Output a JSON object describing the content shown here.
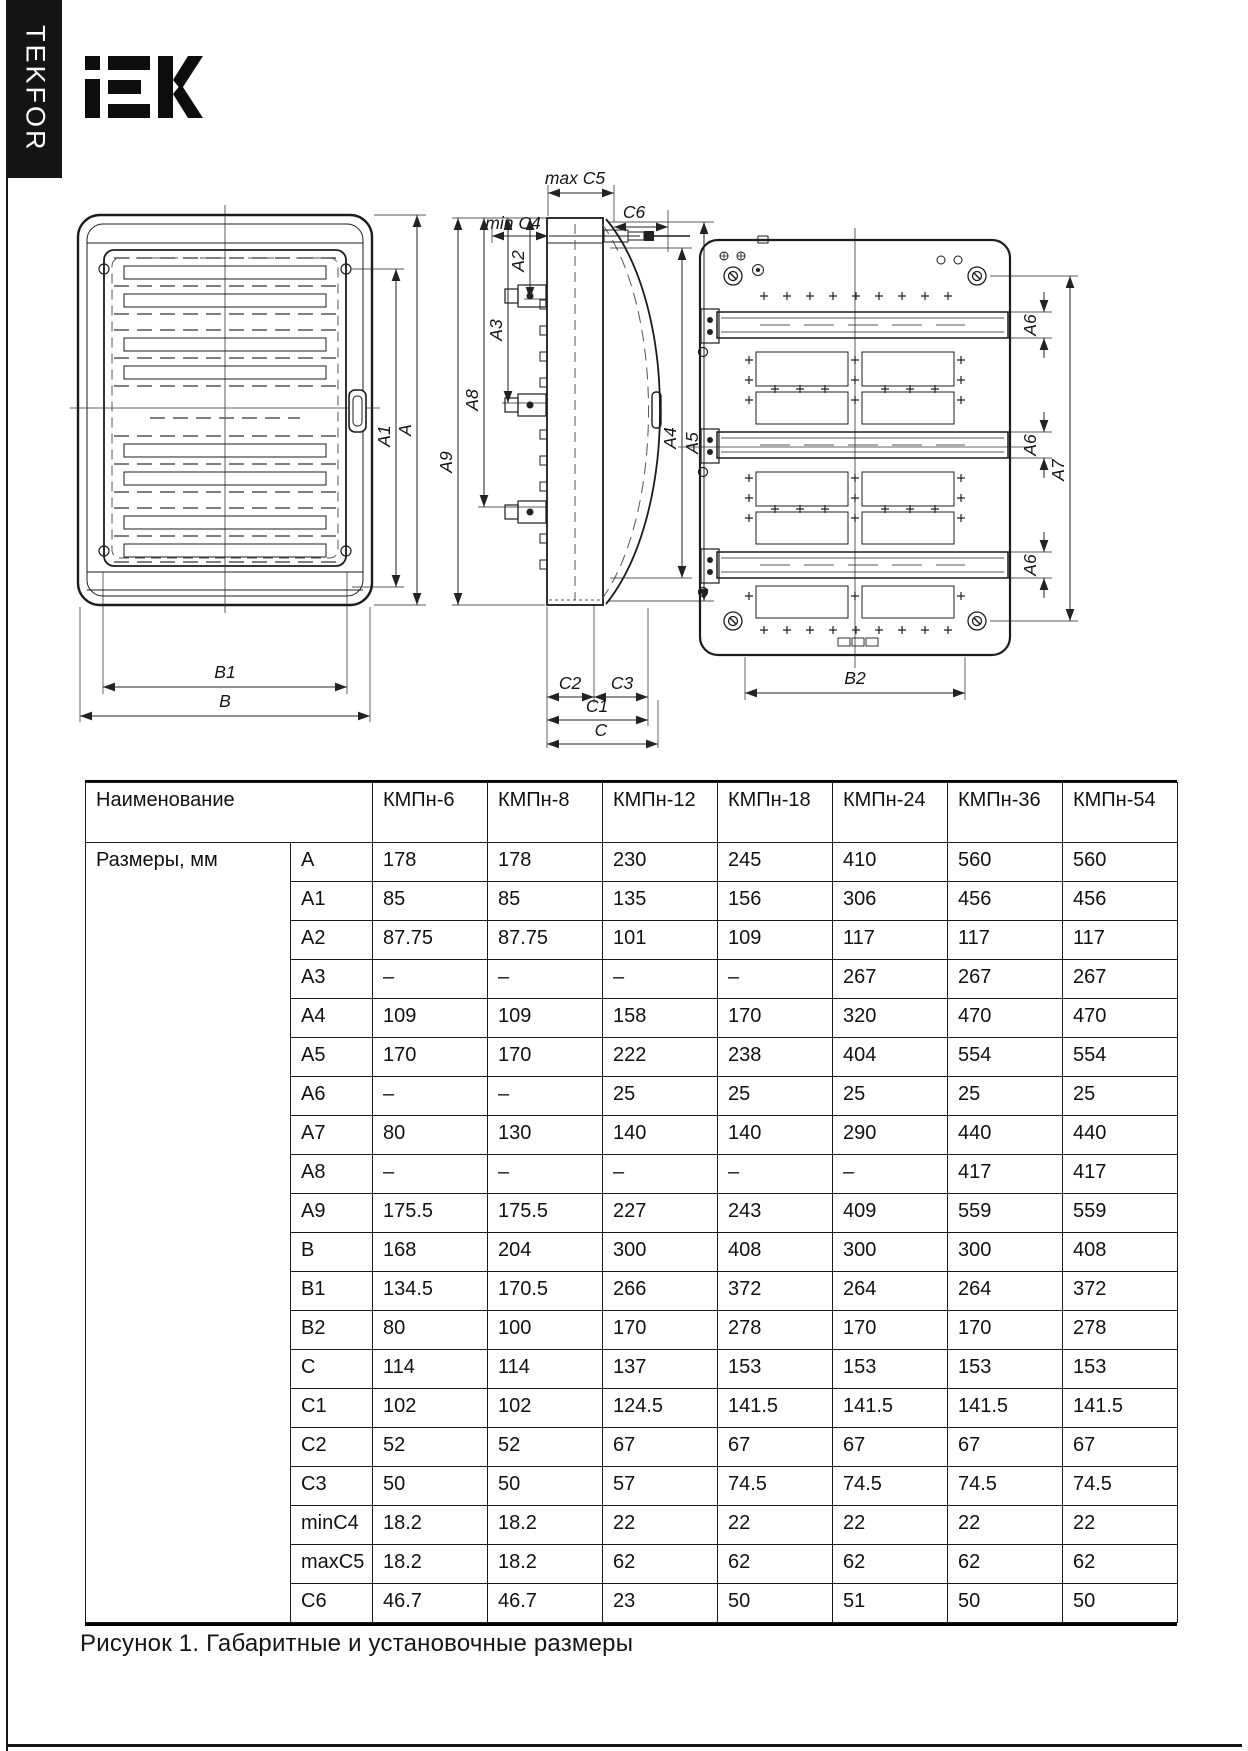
{
  "brand": {
    "sidebar_text": "TEKFOR",
    "logo_text": "IEK"
  },
  "figure": {
    "caption": "Рисунок 1. Габаритные и установочные размеры",
    "front_view": {
      "dims": {
        "a1": "A1",
        "a": "A",
        "b1": "B1",
        "b": "B"
      }
    },
    "side_view": {
      "dims": {
        "max_c5": "max C5",
        "c6": "C6",
        "min_c4": "min C4",
        "a2": "A2",
        "a3": "A3",
        "a8": "A8",
        "a9": "A9",
        "a4": "A4",
        "a5": "A5",
        "c2": "C2",
        "c3": "C3",
        "c1": "C1",
        "c": "C"
      }
    },
    "back_view": {
      "dims": {
        "a6": "A6",
        "a7": "A7",
        "b2": "B2"
      }
    }
  },
  "table": {
    "name_header": "Наименование",
    "group_label": "Размеры, мм",
    "models": [
      "КМПн-6",
      "КМПн-8",
      "КМПн-12",
      "КМПн-18",
      "КМПн-24",
      "КМПн-36",
      "КМПн-54"
    ],
    "rows": [
      {
        "dim": "A",
        "values": [
          "178",
          "178",
          "230",
          "245",
          "410",
          "560",
          "560"
        ]
      },
      {
        "dim": "A1",
        "values": [
          "85",
          "85",
          "135",
          "156",
          "306",
          "456",
          "456"
        ]
      },
      {
        "dim": "A2",
        "values": [
          "87.75",
          "87.75",
          "101",
          "109",
          "117",
          "117",
          "117"
        ]
      },
      {
        "dim": "A3",
        "values": [
          "–",
          "–",
          "–",
          "–",
          "267",
          "267",
          "267"
        ]
      },
      {
        "dim": "A4",
        "values": [
          "109",
          "109",
          "158",
          "170",
          "320",
          "470",
          "470"
        ]
      },
      {
        "dim": "A5",
        "values": [
          "170",
          "170",
          "222",
          "238",
          "404",
          "554",
          "554"
        ]
      },
      {
        "dim": "A6",
        "values": [
          "–",
          "–",
          "25",
          "25",
          "25",
          "25",
          "25"
        ]
      },
      {
        "dim": "A7",
        "values": [
          "80",
          "130",
          "140",
          "140",
          "290",
          "440",
          "440"
        ]
      },
      {
        "dim": "A8",
        "values": [
          "–",
          "–",
          "–",
          "–",
          "–",
          "417",
          "417"
        ]
      },
      {
        "dim": "A9",
        "values": [
          "175.5",
          "175.5",
          "227",
          "243",
          "409",
          "559",
          "559"
        ]
      },
      {
        "dim": "B",
        "values": [
          "168",
          "204",
          "300",
          "408",
          "300",
          "300",
          "408"
        ]
      },
      {
        "dim": "B1",
        "values": [
          "134.5",
          "170.5",
          "266",
          "372",
          "264",
          "264",
          "372"
        ]
      },
      {
        "dim": "B2",
        "values": [
          "80",
          "100",
          "170",
          "278",
          "170",
          "170",
          "278"
        ]
      },
      {
        "dim": "C",
        "values": [
          "114",
          "114",
          "137",
          "153",
          "153",
          "153",
          "153"
        ]
      },
      {
        "dim": "C1",
        "values": [
          "102",
          "102",
          "124.5",
          "141.5",
          "141.5",
          "141.5",
          "141.5"
        ]
      },
      {
        "dim": "C2",
        "values": [
          "52",
          "52",
          "67",
          "67",
          "67",
          "67",
          "67"
        ]
      },
      {
        "dim": "C3",
        "values": [
          "50",
          "50",
          "57",
          "74.5",
          "74.5",
          "74.5",
          "74.5"
        ]
      },
      {
        "dim": "minC4",
        "values": [
          "18.2",
          "18.2",
          "22",
          "22",
          "22",
          "22",
          "22"
        ]
      },
      {
        "dim": "maxC5",
        "values": [
          "18.2",
          "18.2",
          "62",
          "62",
          "62",
          "62",
          "62"
        ]
      },
      {
        "dim": "C6",
        "values": [
          "46.7",
          "46.7",
          "23",
          "50",
          "51",
          "50",
          "50"
        ]
      }
    ]
  }
}
